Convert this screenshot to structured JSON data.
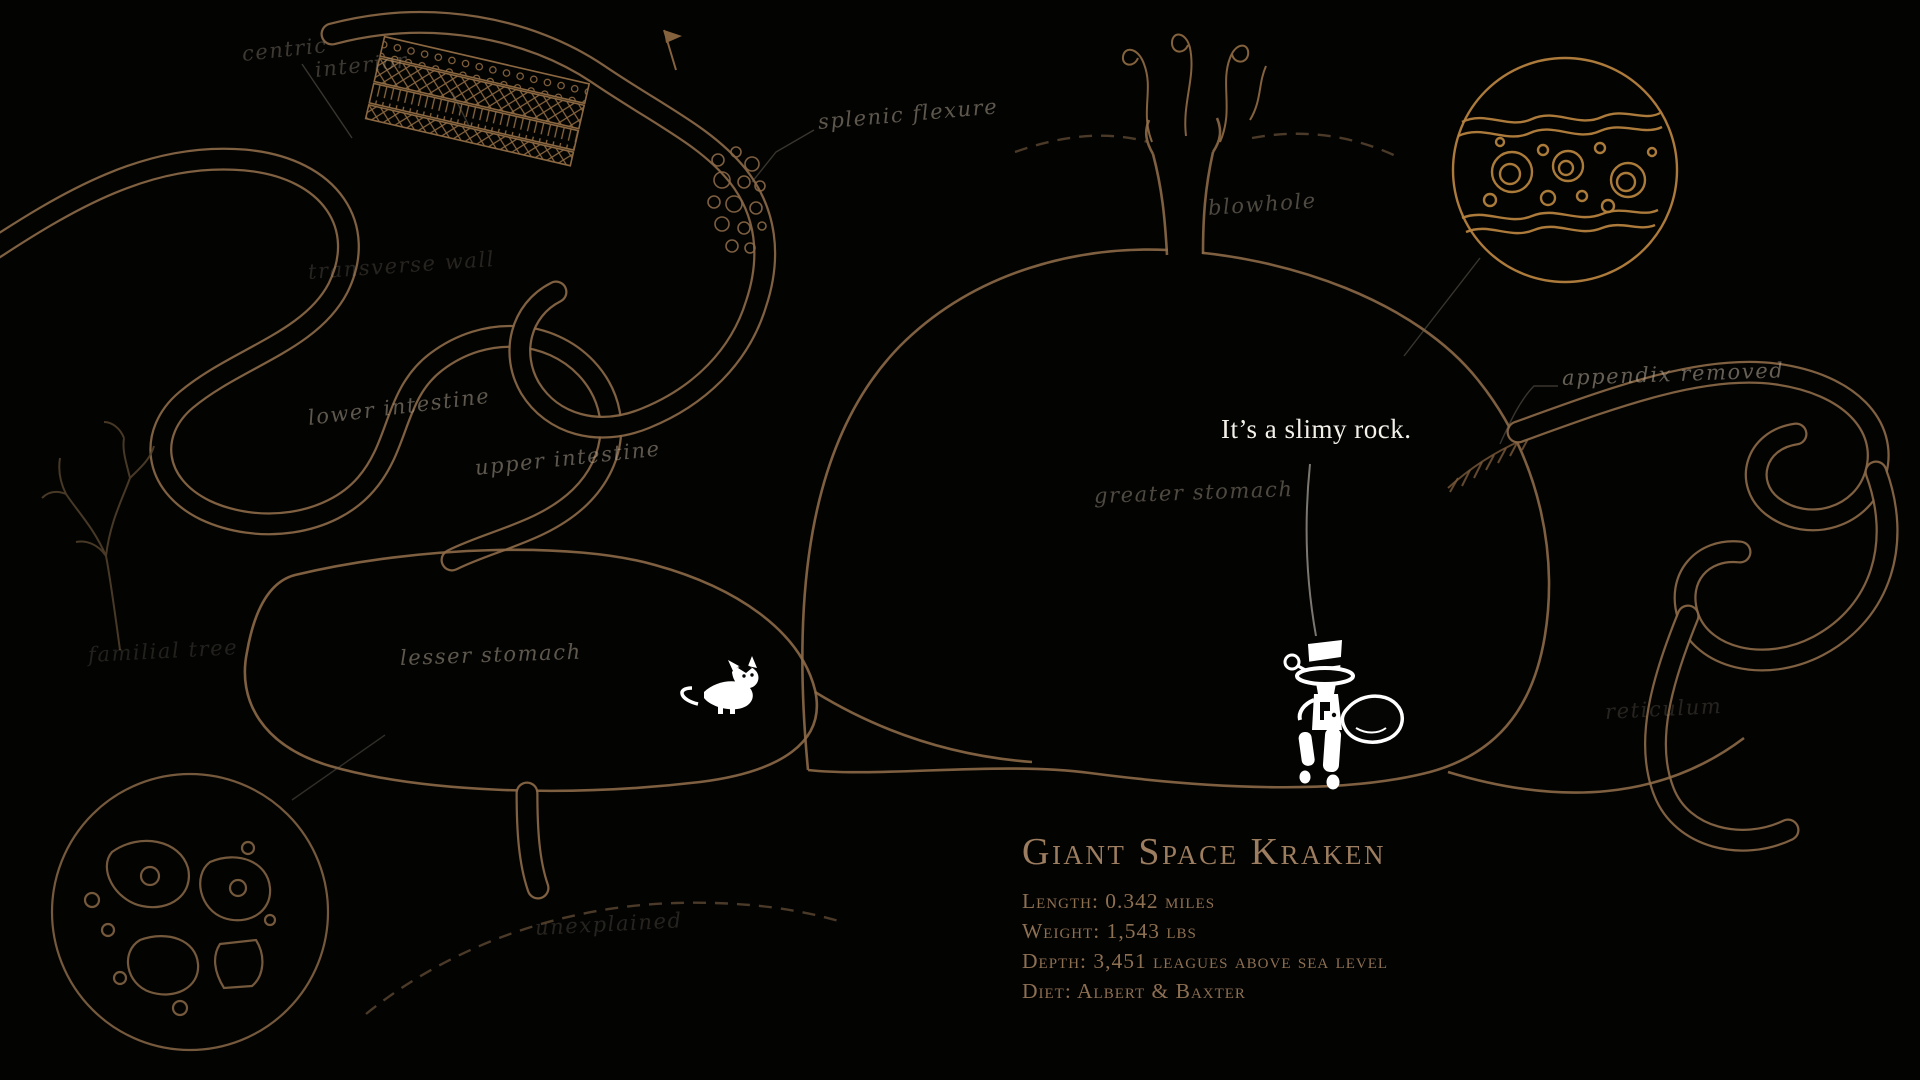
{
  "speech": {
    "text": "It’s a slimy rock."
  },
  "labels": [
    {
      "id": "centric",
      "text": "centric"
    },
    {
      "id": "interior",
      "text": "interior"
    },
    {
      "id": "splenic-flexure",
      "text": "splenic flexure"
    },
    {
      "id": "blowhole",
      "text": "blowhole"
    },
    {
      "id": "transverse-wall",
      "text": "transverse wall"
    },
    {
      "id": "lower-intestine",
      "text": "lower intestine"
    },
    {
      "id": "upper-intestine",
      "text": "upper intestine"
    },
    {
      "id": "greater-stomach",
      "text": "greater stomach"
    },
    {
      "id": "appendix-removed",
      "text": "appendix removed"
    },
    {
      "id": "lesser-stomach",
      "text": "lesser stomach"
    },
    {
      "id": "familial-tree",
      "text": "familial tree"
    },
    {
      "id": "reticulum",
      "text": "reticulum"
    },
    {
      "id": "unexplained",
      "text": "unexplained"
    }
  ],
  "info_panel": {
    "title": "Giant Space Kraken",
    "lines": [
      "Length: 0.342 miles",
      "Weight: 1,543 lbs",
      "Depth: 3,451 leagues above sea level",
      "Diet: Albert & Baxter"
    ]
  },
  "icons": {
    "cat_sprite": "small white cat character",
    "detective_sprite": "character wearing a top hat",
    "slimy_rock": "outlined slimy rock",
    "flag_marker": "small pennant flag",
    "tree_branch": "bare branching tree sketch",
    "microscope_inset_top_right": "magnified cell detail circle",
    "microscope_inset_bottom_left": "magnified cell detail circle"
  },
  "colors": {
    "background": "#030302",
    "tube_line": "#8a6847",
    "bright_line": "#b5823e",
    "label_text": "#b6aa97",
    "title_text": "#9d7d5f",
    "speech_text": "#f4f1e9",
    "sprite": "#ffffff"
  }
}
